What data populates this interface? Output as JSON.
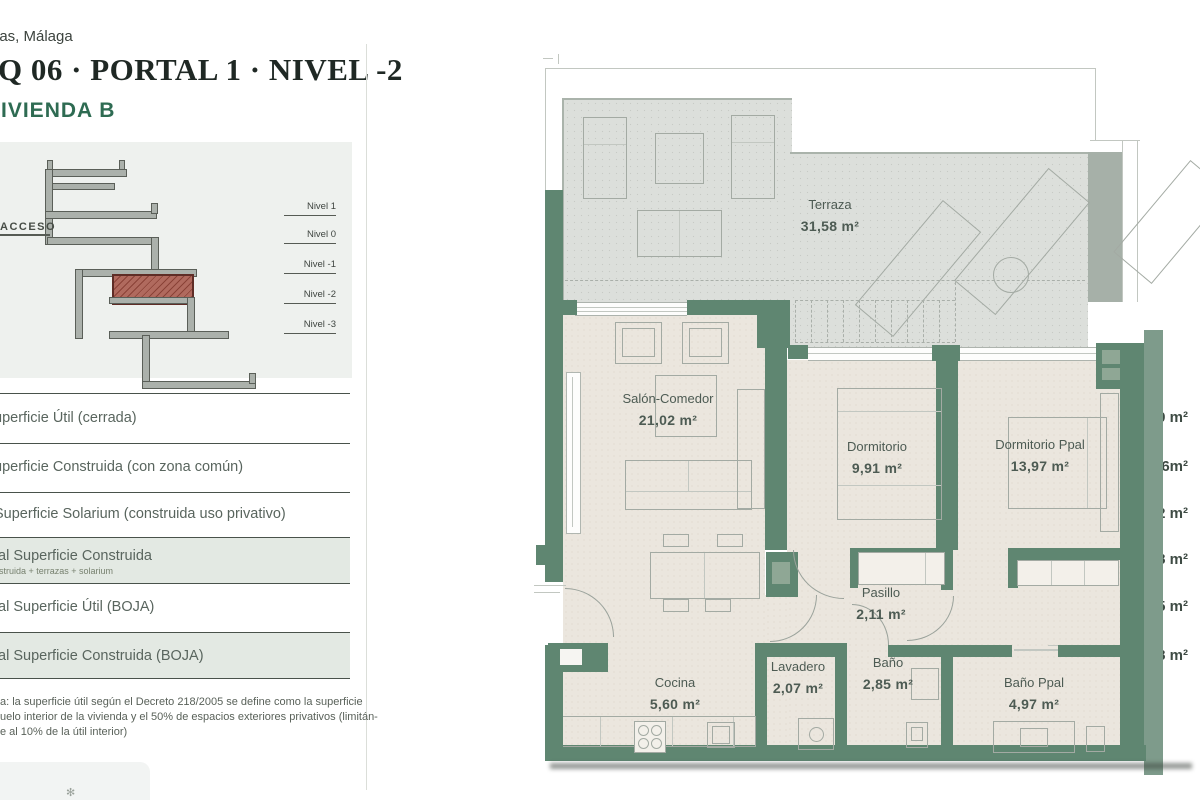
{
  "header": {
    "location": "jas, Málaga",
    "title": "Q 06 · PORTAL 1 · NIVEL -2",
    "subtitle": "VIVIENDA B"
  },
  "section_diagram": {
    "access_label": "ACCESO",
    "levels": [
      "Nivel 1",
      "Nivel 0",
      "Nivel -1",
      "Nivel -2",
      "Nivel -3"
    ]
  },
  "area_table": {
    "rows": [
      {
        "label": "uperficie Útil (cerrada)",
        "value": "62.50 m²"
      },
      {
        "label": "uperficie Construida (con zona común)",
        "value": "98.06m²"
      },
      {
        "label": "Superficie Solarium (construida uso privativo)",
        "value": "36.22 m²"
      },
      {
        "label": "tal Superficie Construida",
        "sublabel": "nstruida + terrazas + solarium",
        "value": "133.48 m²"
      },
      {
        "label": "tal Superficie Útil (BOJA)",
        "value": "68.75 m²"
      },
      {
        "label": "tal Superficie Construida (BOJA)",
        "value": "106.98 m²"
      }
    ],
    "note_lines": [
      "a: la superficie útil según el Decreto 218/2005 se define como la superficie",
      "uelo interior de la vivienda y el 50% de espacios exteriores privativos (limitán-",
      "e al 10% de la útil interior)"
    ]
  },
  "floor_plan": {
    "rooms": [
      {
        "name": "Terraza",
        "area": "31,58 m²"
      },
      {
        "name": "Salón-Comedor",
        "area": "21,02 m²"
      },
      {
        "name": "Dormitorio",
        "area": "9,91 m²"
      },
      {
        "name": "Dormitorio Ppal",
        "area": "13,97 m²"
      },
      {
        "name": "Pasillo",
        "area": "2,11 m²"
      },
      {
        "name": "Cocina",
        "area": "5,60 m²"
      },
      {
        "name": "Lavadero",
        "area": "2,07 m²"
      },
      {
        "name": "Baño",
        "area": "2,85 m²"
      },
      {
        "name": "Baño Ppal",
        "area": "4,97 m²"
      }
    ]
  },
  "colors": {
    "wall_green": "#5f8671",
    "wall_light": "#8fa795",
    "outer_band": "#7e9b8b",
    "floor_beige": "#ebe6de",
    "terrace_gray": "#dcdfdb",
    "brand_green": "#2e6b52",
    "highlight_row": "#e3e9e3",
    "section_marker_red": "#8a4237"
  }
}
